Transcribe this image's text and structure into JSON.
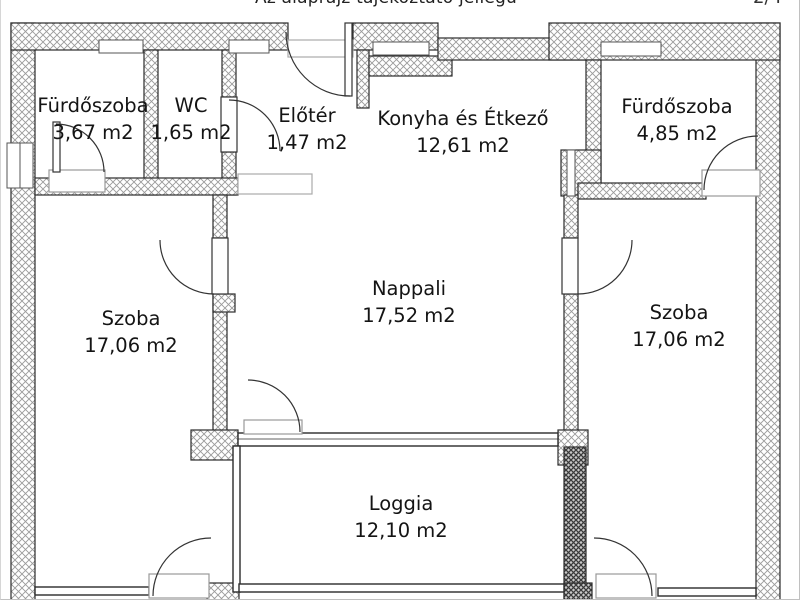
{
  "page": {
    "title": "Az alaprajz tájékoztató jellegű",
    "corner_marker": "2/4"
  },
  "floorplan": {
    "rooms": [
      {
        "name": "Fürdőszoba",
        "area": "3,67 m2"
      },
      {
        "name": "WC",
        "area": "1,65 m2"
      },
      {
        "name": "Előtér",
        "area": "1,47 m2"
      },
      {
        "name": "Konyha és Étkező",
        "area": "12,61 m2"
      },
      {
        "name": "Fürdőszoba",
        "area": "4,85 m2"
      },
      {
        "name": "Szoba",
        "area": "17,06 m2"
      },
      {
        "name": "Nappali",
        "area": "17,52 m2"
      },
      {
        "name": "Szoba",
        "area": "17,06 m2"
      },
      {
        "name": "Loggia",
        "area": "12,10 m2"
      }
    ],
    "colors": {
      "background": "#ffffff",
      "wall_hatch": "#9a9a9a",
      "wall_outline": "#2b2b2b",
      "dark_wall": "#3a3a3a",
      "text": "#141414"
    }
  }
}
